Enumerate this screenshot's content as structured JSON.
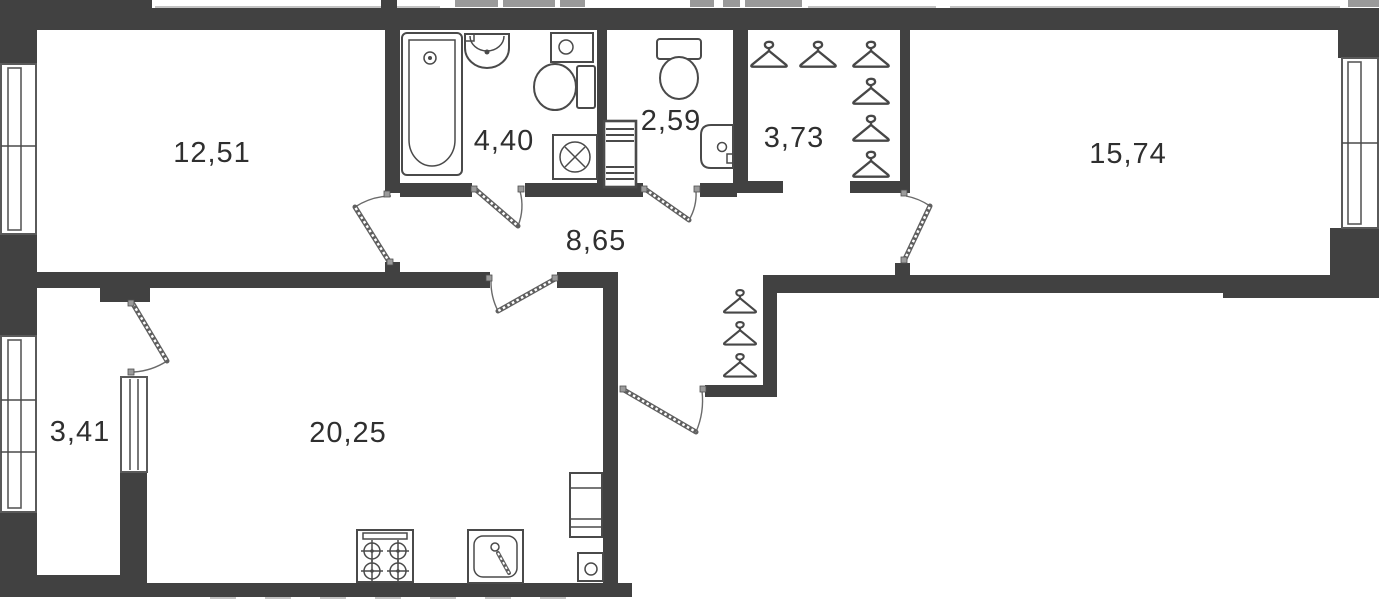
{
  "plan": {
    "colors": {
      "wall": "#414141",
      "fixture_stroke": "#4a4a4a",
      "label_text": "#2f2f2f",
      "background": "#ffffff"
    },
    "rooms": [
      {
        "id": "room-top-left",
        "area": "12,51"
      },
      {
        "id": "bathroom",
        "area": "4,40"
      },
      {
        "id": "wc",
        "area": "2,59"
      },
      {
        "id": "wardrobe",
        "area": "3,73"
      },
      {
        "id": "room-top-right",
        "area": "15,74"
      },
      {
        "id": "hallway",
        "area": "8,65"
      },
      {
        "id": "kitchen-living",
        "area": "20,25"
      },
      {
        "id": "balcony",
        "area": "3,41"
      }
    ],
    "icons": [
      "bathtub",
      "bathroom-sink",
      "water-heater",
      "toilet",
      "washing-machine",
      "vent-shaft",
      "wc-toilet",
      "corner-sink",
      "hanger",
      "stove",
      "kitchen-sink",
      "tall-cabinet",
      "boiler",
      "window",
      "door-swing"
    ]
  }
}
